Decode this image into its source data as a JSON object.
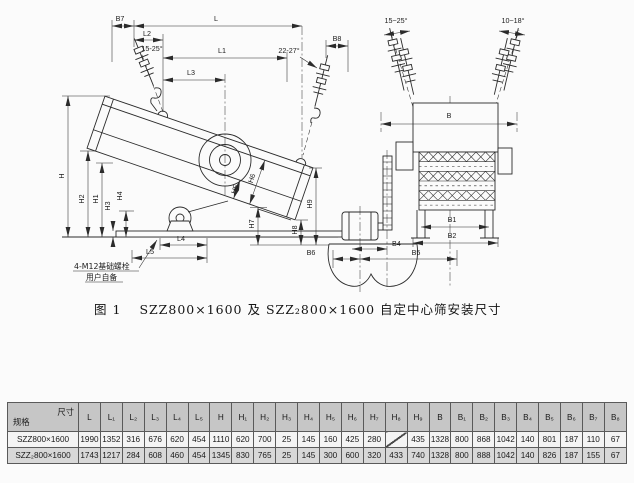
{
  "colors": {
    "line": "#2b2b2b",
    "table_header_bg": "#c6c6c6",
    "table_row2_bg": "#d8d8d8",
    "page_bg": "#fbfbfb"
  },
  "drawing": {
    "labels": {
      "B7": "B7",
      "L": "L",
      "L1": "L1",
      "L2": "L2",
      "L3": "L3",
      "L4": "L4",
      "L5": "L5",
      "angle_feed_hanger": "15-25°",
      "angle_discharge_hanger": "22-27°",
      "B8": "B8",
      "H": "H",
      "H1": "H1",
      "H2": "H2",
      "H3": "H3",
      "H4": "H4",
      "H5": "H5",
      "H6": "H6",
      "H7": "H7",
      "H8": "H8",
      "H9": "H9",
      "angle_front_left": "15~25°",
      "angle_front_right": "10~18°",
      "B": "B",
      "B1": "B1",
      "B2": "B2",
      "B4": "B4",
      "B5": "B5",
      "B6": "B6"
    },
    "note": {
      "line1": "4-M12基础螺栓",
      "line2": "用户自备"
    }
  },
  "caption": {
    "figure_no": "图 1",
    "text": "SZZ800×1600 及 SZZ₂800×1600 自定中心筛安装尺寸"
  },
  "table": {
    "corner": {
      "top_right": "尺寸",
      "bottom_left": "规格"
    },
    "columns": [
      "L",
      "L₁",
      "L₂",
      "L₃",
      "L₄",
      "L₅",
      "H",
      "H₁",
      "H₂",
      "H₃",
      "H₄",
      "H₅",
      "H₆",
      "H₇",
      "H₈",
      "H₉",
      "B",
      "B₁",
      "B₂",
      "B₃",
      "B₄",
      "B₅",
      "B₆",
      "B₇",
      "B₈"
    ],
    "rows": [
      {
        "model": "SZZ800×1600",
        "values": [
          "1990",
          "1352",
          "316",
          "676",
          "620",
          "454",
          "1110",
          "620",
          "700",
          "25",
          "145",
          "160",
          "425",
          "280",
          "",
          "435",
          "1328",
          "800",
          "868",
          "1042",
          "140",
          "801",
          "187",
          "110",
          "67"
        ]
      },
      {
        "model": "SZZ₂800×1600",
        "values": [
          "1743",
          "1217",
          "284",
          "608",
          "460",
          "454",
          "1345",
          "830",
          "765",
          "25",
          "145",
          "300",
          "600",
          "320",
          "433",
          "740",
          "1328",
          "800",
          "888",
          "1042",
          "140",
          "826",
          "187",
          "155",
          "67"
        ]
      }
    ]
  }
}
